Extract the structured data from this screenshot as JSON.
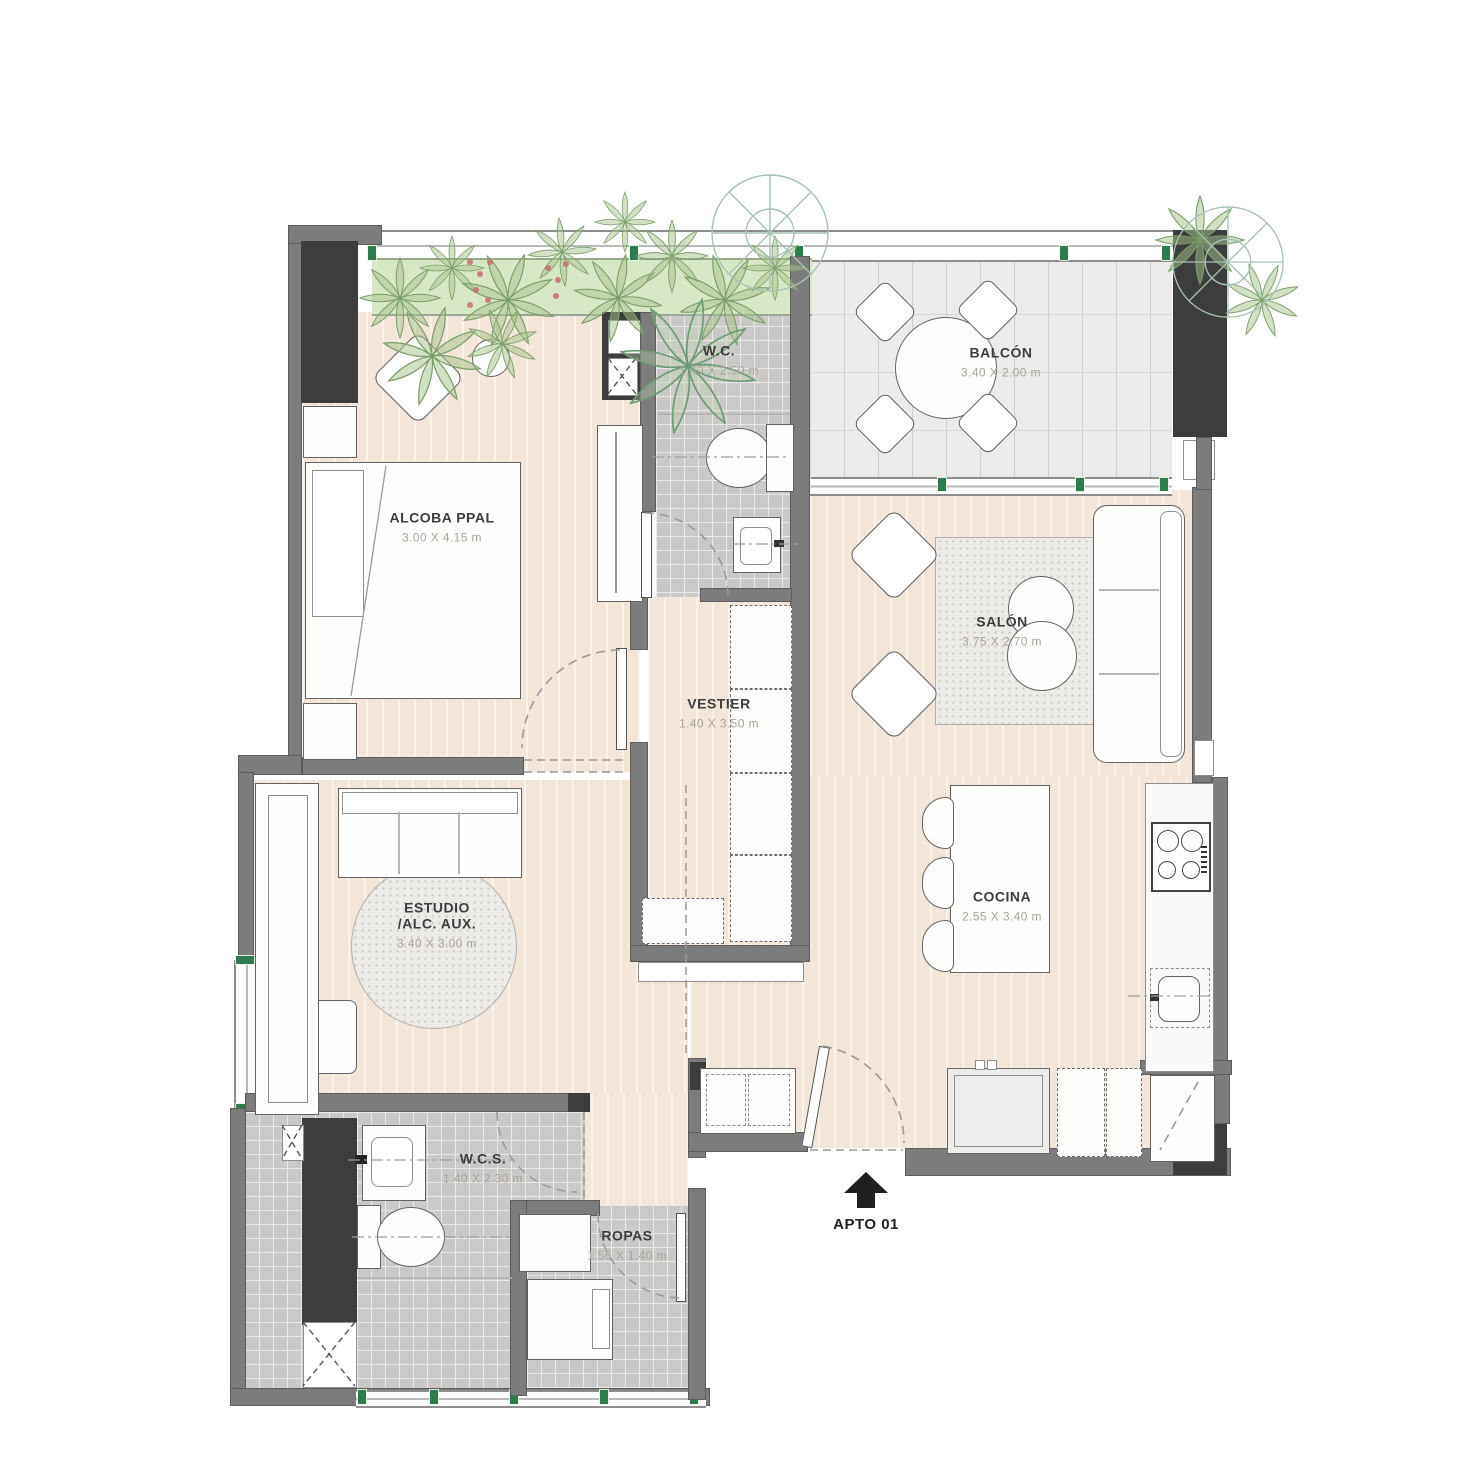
{
  "unit": {
    "label": "APTO 01"
  },
  "rooms": [
    {
      "id": "alcoba",
      "name": "ALCOBA PPAL",
      "dims": "3.00 X 4.15 m"
    },
    {
      "id": "wc",
      "name": "W.C.",
      "dims": "1.40 X 2.50 m"
    },
    {
      "id": "balcon",
      "name": "BALCÓN",
      "dims": "3.40 X 2.00 m"
    },
    {
      "id": "salon",
      "name": "SALÓN",
      "dims": "3.75 X 2.70 m"
    },
    {
      "id": "vestier",
      "name": "VESTIER",
      "dims": "1.40 X 3.50 m"
    },
    {
      "id": "estudio",
      "name_line1": "ESTUDIO",
      "name_line2": "/ALC. AUX.",
      "dims": "3.40 X 3.00 m"
    },
    {
      "id": "cocina",
      "name": "COCINA",
      "dims": "2.55 X 3.40 m"
    },
    {
      "id": "wcs",
      "name": "W.C.S.",
      "dims": "1.40 X 2.30 m"
    },
    {
      "id": "ropas",
      "name": "ROPAS",
      "dims": "1.56 X 1.40 m"
    }
  ],
  "colors": {
    "wall_gray": "#7c7c7c",
    "wall_dark": "#3d3d3d",
    "floor_wood": "#f3e5d7",
    "floor_tile": "#cbc9c7",
    "floor_balcony": "#ebebe9",
    "planter_green": "#d8e8c6",
    "mullion_green": "#2e7b4e",
    "label_text": "#3d3d3d",
    "dim_text": "#a9a39b"
  },
  "icons": {
    "entrance_arrow": "up-arrow"
  }
}
